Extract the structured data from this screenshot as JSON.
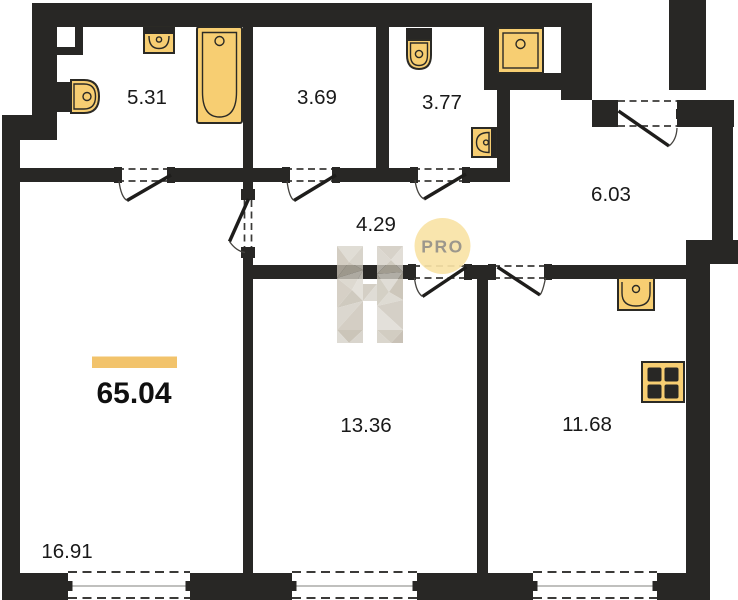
{
  "plan": {
    "title": "apartment-floor-plan",
    "total_area": "65.04",
    "badge_label": "PRO",
    "rooms": [
      {
        "id": "bathroom",
        "area": "5.31"
      },
      {
        "id": "wc",
        "area": "3.69"
      },
      {
        "id": "laundry",
        "area": "3.77"
      },
      {
        "id": "hallway",
        "area": "4.29"
      },
      {
        "id": "entry-hall",
        "area": "6.03"
      },
      {
        "id": "bedroom",
        "area": "13.36"
      },
      {
        "id": "kitchen",
        "area": "11.68"
      },
      {
        "id": "living-room",
        "area": "16.91"
      }
    ],
    "fixtures": [
      "toilet",
      "wall-sink",
      "bathtub",
      "toilet",
      "washing-machine",
      "hand-sink",
      "kitchen-sink",
      "stove"
    ],
    "colors": {
      "wall": "#282725",
      "fixture_fill": "#F7CE72",
      "fixture_stroke": "#2b2a25",
      "accent_bar": "#F2C36B",
      "badge_fill": "#F8E3A6",
      "badge_text": "#9C978C"
    }
  }
}
